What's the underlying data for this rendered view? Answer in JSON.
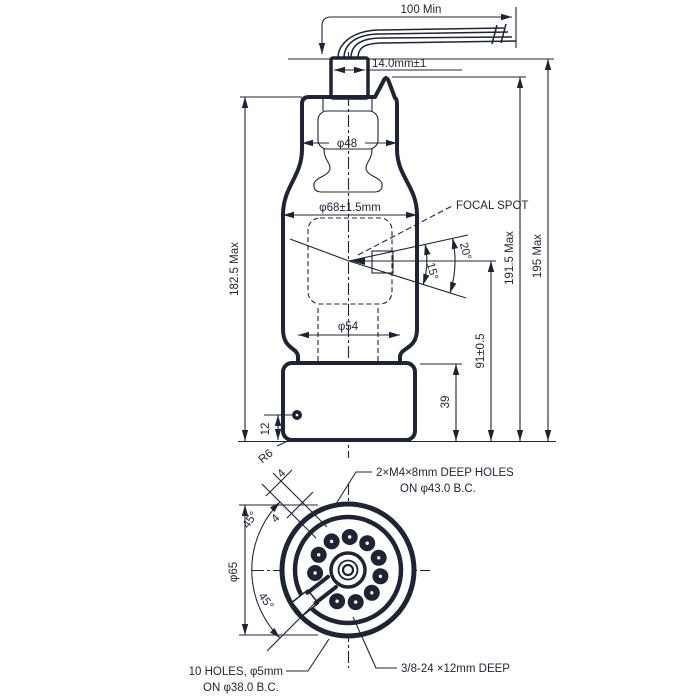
{
  "colors": {
    "line": "#1d2433",
    "background": "#ffffff"
  },
  "front_view": {
    "dims": {
      "cable_min_length": "100 Min",
      "cap_width": "14.0mm±1",
      "neck_diameter": "φ48",
      "bulb_diameter": "φ68±1.5mm",
      "lower_diameter": "φ54",
      "envelope_height": "182.5 Max",
      "tip_height": "191.5 Max",
      "overall_height": "195 Max",
      "focal_to_base": "91±0.5",
      "base_height": "39",
      "hole_offset": "12",
      "corner_radius": "R6",
      "beam_angle": "20°",
      "target_angle": "15°"
    },
    "labels": {
      "focal_spot": "FOCAL SPOT"
    }
  },
  "bottom_view": {
    "dims": {
      "flange_diameter": "φ65",
      "upper_angle": "45°",
      "lower_angle": "45°",
      "key_width_a": "4",
      "key_width_b": "4"
    },
    "notes": {
      "m4_holes_line1": "2×M4×8mm DEEP HOLES",
      "m4_holes_line2": "ON φ43.0 B.C.",
      "pin_holes_line1": "10 HOLES, φ5mm",
      "pin_holes_line2": "ON φ38.0 B.C.",
      "center_thread": "3/8-24 ×12mm DEEP"
    },
    "pin_count": 10,
    "pin_bolt_circle_radius_px": 33,
    "pin_radius_px": 8
  }
}
